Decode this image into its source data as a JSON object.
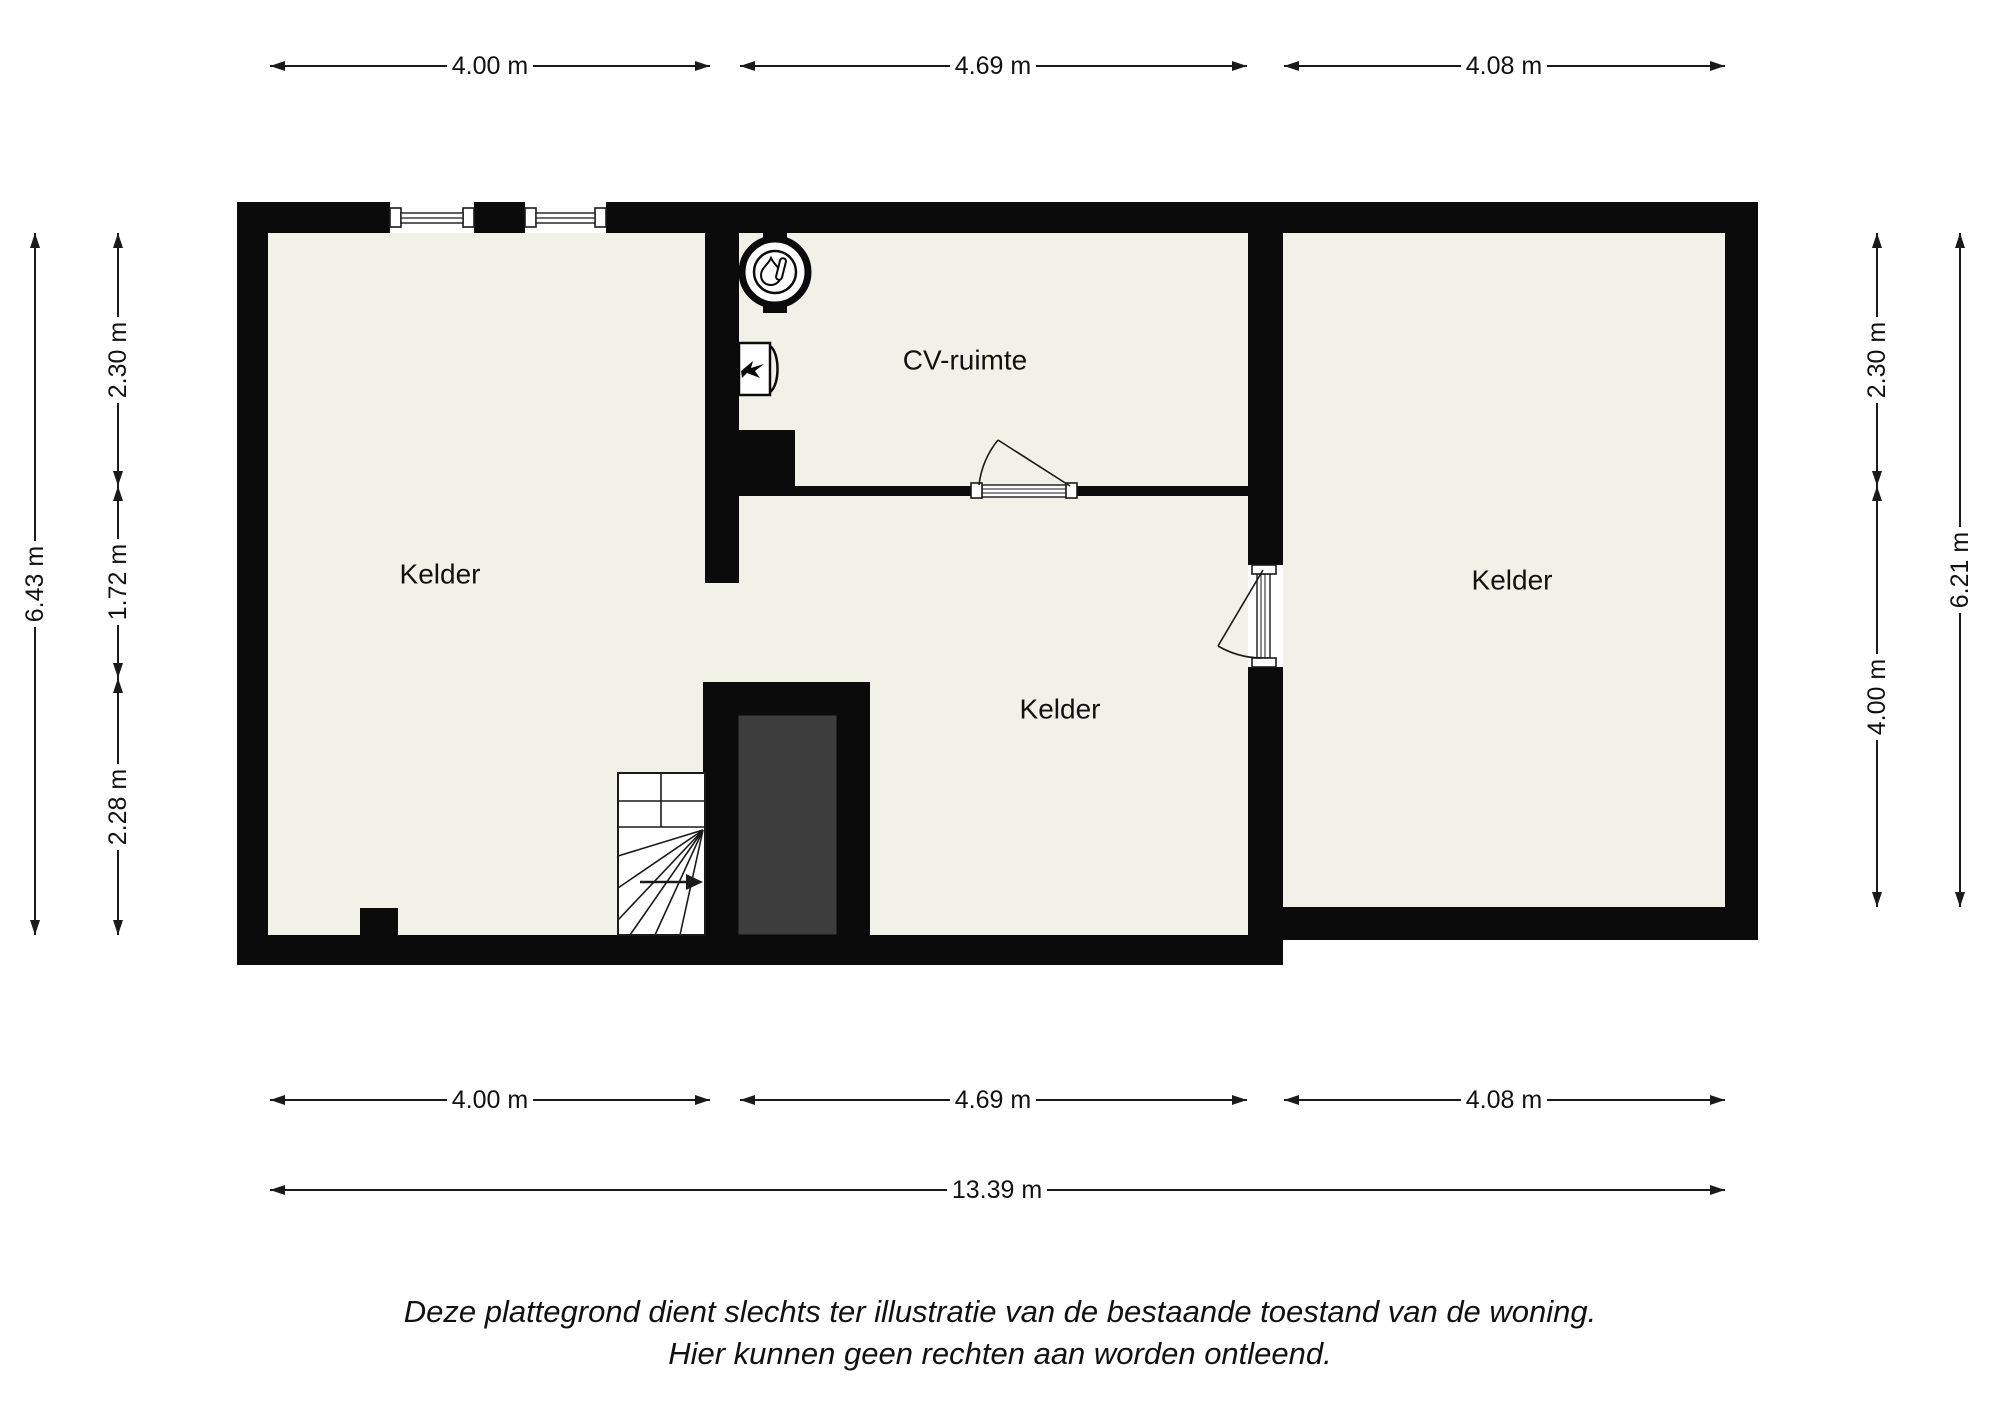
{
  "rooms": {
    "left": "Kelder",
    "cv": "CV-ruimte",
    "middle": "Kelder",
    "right": "Kelder"
  },
  "dims": {
    "top": [
      "4.00 m",
      "4.69 m",
      "4.08 m"
    ],
    "bottom": [
      "4.00 m",
      "4.69 m",
      "4.08 m"
    ],
    "total_width": "13.39 m",
    "left_outer": "6.43 m",
    "left_segments": [
      "2.30 m",
      "1.72 m",
      "2.28 m"
    ],
    "right_segments": [
      "2.30 m",
      "4.00 m"
    ],
    "right_outer": "6.21 m"
  },
  "disclaimer": {
    "line1": "Deze plattegrond dient slechts ter illustratie van de bestaande toestand van de woning.",
    "line2": "Hier kunnen geen rechten aan worden ontleend."
  },
  "icons": {
    "boiler": "boiler-circle-icon",
    "heater": "wall-heater-icon",
    "stairs_arrow": "stairs-direction-arrow-icon"
  },
  "colors": {
    "wall": "#0b0b0b",
    "floor": "#f2f1e7",
    "shaft": "#3d3d3d",
    "background": "#ffffff"
  }
}
